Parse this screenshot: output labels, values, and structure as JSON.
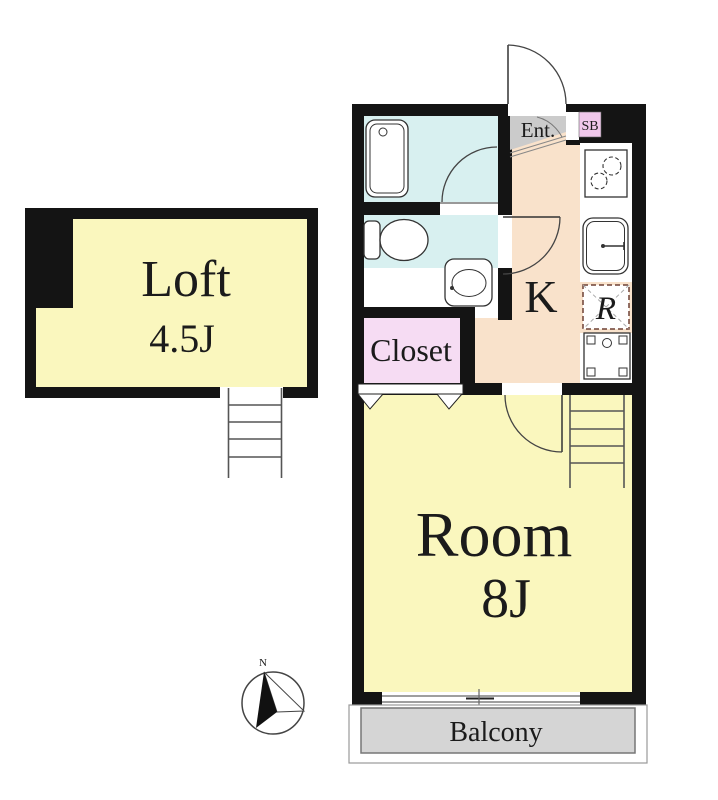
{
  "colors": {
    "wall": "#141414",
    "tatami_yellow": "#FAF7BE",
    "water_blue": "#D8F0F0",
    "kitchen_peach": "#F9E2CB",
    "closet_pink": "#F6DCF3",
    "sb_pink": "#F0C8EB",
    "entrance_gray": "#CBCBCB",
    "balcony_gray": "#D5D5D5",
    "fridge_dash": "#6E4135"
  },
  "rooms": {
    "loft": {
      "label": "Loft",
      "size": "4.5J"
    },
    "room": {
      "label": "Room",
      "size": "8J"
    },
    "kitchen": {
      "label": "K"
    },
    "closet": {
      "label": "Closet"
    },
    "entrance": {
      "label": "Ent."
    },
    "shoe_box": {
      "label": "SB"
    },
    "balcony": {
      "label": "Balcony"
    }
  },
  "fixtures": {
    "refrigerator_label": "R"
  },
  "compass": {
    "north_label": "N"
  }
}
